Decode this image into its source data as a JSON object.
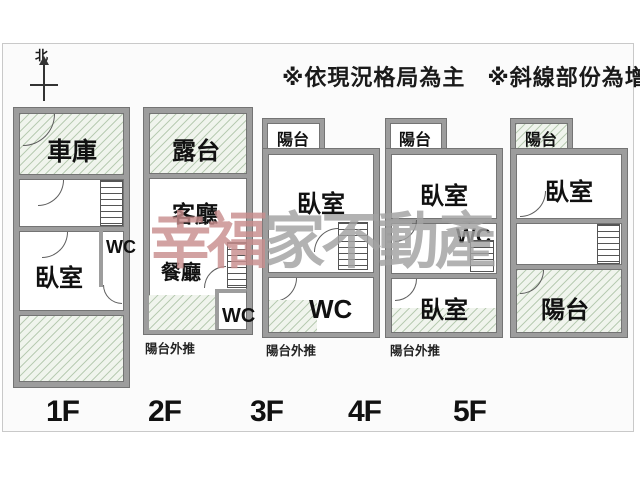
{
  "header": {
    "north_label": "北",
    "disclaimer_1": "※依現況格局為主",
    "disclaimer_2": "※斜線部份為增建"
  },
  "watermark": {
    "part_1": "幸福",
    "part_2": "家不動產",
    "color_1": "#c98e8e",
    "color_2": "#a2a2a2"
  },
  "colors": {
    "wall": "#9d9d9d",
    "wall_edge": "#747474",
    "hatch_fill": "#f0f4ed",
    "hatch_line": "#8caa84"
  },
  "floors": [
    {
      "label": "1F",
      "rooms": {
        "garage": "車庫",
        "bedroom": "臥室",
        "wc": "WC"
      }
    },
    {
      "label": "2F",
      "rooms": {
        "terrace": "露台",
        "living": "客廳",
        "dining": "餐廳",
        "wc": "WC"
      },
      "caption": "陽台外推"
    },
    {
      "label": "3F",
      "rooms": {
        "balcony": "陽台",
        "bedroom": "臥室",
        "wc": "WC"
      },
      "caption": "陽台外推"
    },
    {
      "label": "4F",
      "rooms": {
        "balcony": "陽台",
        "bedroom_upper": "臥室",
        "wc": "WC",
        "bedroom_lower": "臥室"
      },
      "caption": "陽台外推"
    },
    {
      "label": "5F",
      "rooms": {
        "balcony_top": "陽台",
        "bedroom": "臥室",
        "balcony_bottom": "陽台"
      }
    }
  ]
}
